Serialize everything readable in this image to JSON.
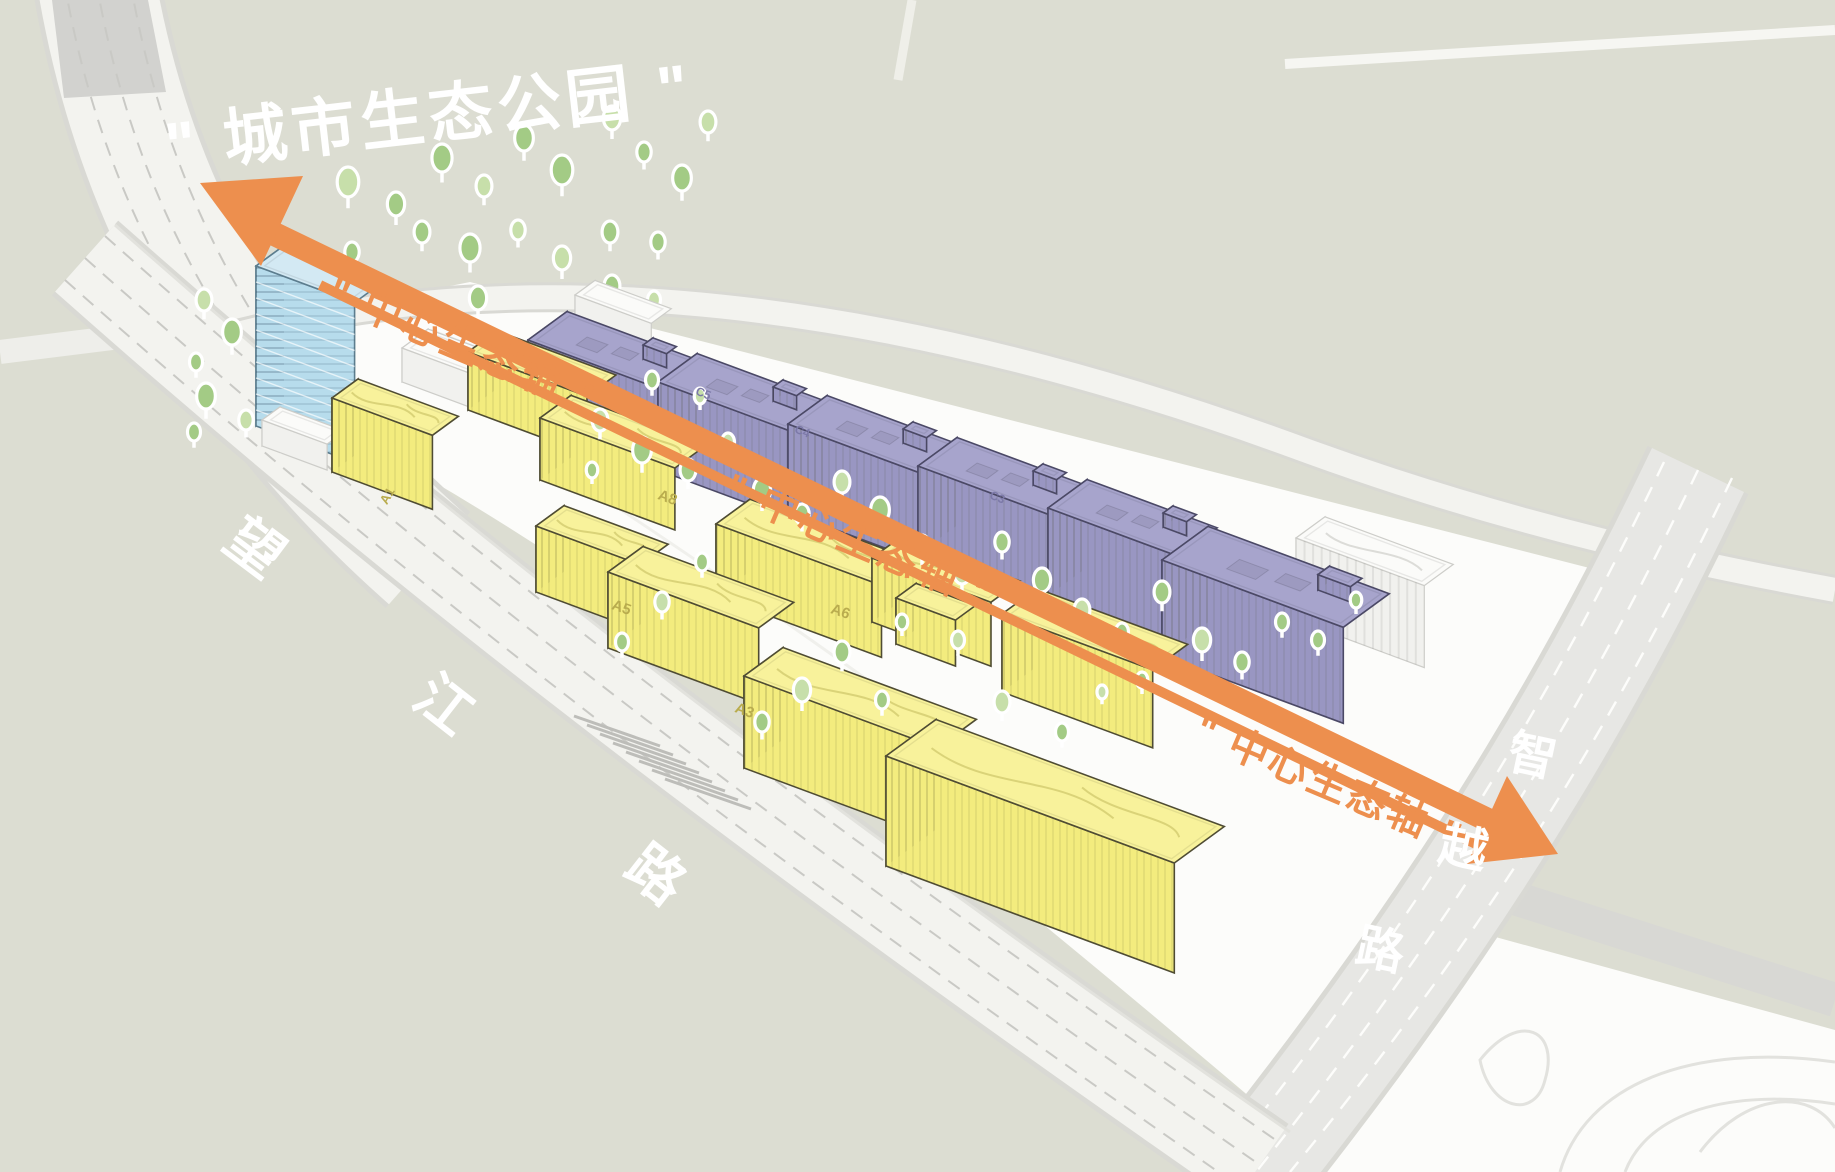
{
  "title": {
    "text": "\" 城市生态公园 \""
  },
  "axis": {
    "label": "\" 中心生态轴 \""
  },
  "roads": {
    "wangjiang": {
      "name": "望江路",
      "chars": [
        "望",
        "江",
        "路"
      ]
    },
    "zhiyue": {
      "name": "智越路",
      "chars": [
        "智",
        "越",
        "路"
      ]
    }
  },
  "buildings": {
    "labels": {
      "a1": "A1",
      "a3": "A3",
      "a5": "A5",
      "a6": "A6",
      "a8": "A8",
      "c3": "C3",
      "c4": "C4",
      "c5": "C5"
    }
  },
  "colors": {
    "background": "#dcddd2",
    "site_white": "#fcfcfa",
    "road_white": "#f3f3ef",
    "road_casing": "#d9d9d4",
    "road_gray": "#e7e7e4",
    "lane_gray": "#c9c9c5",
    "axis_orange": "#ed8f4e",
    "label_white": "#ffffff",
    "tree_green": "#a3cb85",
    "tree_green_light": "#c7dfaa",
    "yellow_roof": "#f8f29b",
    "yellow_face": "#f3ec7e",
    "yellow_side": "#ece470",
    "yellow_edge": "#4f4c33",
    "purple_roof": "#a7a4cc",
    "purple_face": "#9996c2",
    "purple_side": "#8b88b7",
    "purple_edge": "#4b4966",
    "blue_roof": "#d3e9f3",
    "blue_face": "#b7dcec",
    "blue_side": "#a5d0e1",
    "blue_edge": "#5c7d8e",
    "white_roof": "#fbfbf9",
    "white_face": "#f1f1ee",
    "white_side": "#e7e7e3",
    "white_edge": "#cdcdc9",
    "label_dark_yellow": "#b9ac4e",
    "label_dark_purple": "#7c79a8"
  },
  "scene": {
    "trees_back": [
      [
        348,
        182,
        15
      ],
      [
        396,
        204,
        12
      ],
      [
        442,
        158,
        14
      ],
      [
        484,
        186,
        11
      ],
      [
        524,
        138,
        13
      ],
      [
        562,
        170,
        15
      ],
      [
        612,
        118,
        12
      ],
      [
        644,
        152,
        10
      ],
      [
        682,
        178,
        13
      ],
      [
        708,
        122,
        11
      ],
      [
        422,
        232,
        11
      ],
      [
        470,
        248,
        14
      ],
      [
        518,
        230,
        10
      ],
      [
        352,
        252,
        10
      ],
      [
        302,
        282,
        11
      ],
      [
        562,
        258,
        12
      ],
      [
        610,
        232,
        11
      ],
      [
        658,
        242,
        10
      ],
      [
        204,
        300,
        11
      ],
      [
        232,
        332,
        13
      ],
      [
        196,
        362,
        9
      ],
      [
        286,
        346,
        10
      ],
      [
        334,
        302,
        9
      ],
      [
        612,
        286,
        11
      ],
      [
        654,
        300,
        9
      ],
      [
        478,
        298,
        12
      ],
      [
        206,
        396,
        13
      ],
      [
        246,
        420,
        10
      ],
      [
        282,
        440,
        8
      ],
      [
        194,
        432,
        9
      ]
    ],
    "trees_front": [
      [
        600,
        420,
        11
      ],
      [
        642,
        450,
        13
      ],
      [
        688,
        470,
        11
      ],
      [
        728,
        442,
        9
      ],
      [
        762,
        490,
        12
      ],
      [
        802,
        514,
        10
      ],
      [
        842,
        482,
        11
      ],
      [
        880,
        510,
        13
      ],
      [
        922,
        546,
        11
      ],
      [
        962,
        572,
        12
      ],
      [
        1002,
        542,
        10
      ],
      [
        1042,
        580,
        12
      ],
      [
        1082,
        610,
        11
      ],
      [
        1122,
        632,
        9
      ],
      [
        1162,
        592,
        11
      ],
      [
        1202,
        640,
        12
      ],
      [
        1242,
        662,
        10
      ],
      [
        1282,
        622,
        9
      ],
      [
        958,
        640,
        9
      ],
      [
        902,
        622,
        8
      ],
      [
        702,
        562,
        9
      ],
      [
        662,
        602,
        10
      ],
      [
        622,
        642,
        9
      ],
      [
        842,
        652,
        11
      ],
      [
        802,
        690,
        12
      ],
      [
        762,
        722,
        10
      ],
      [
        882,
        700,
        9
      ],
      [
        1002,
        702,
        11
      ],
      [
        1062,
        732,
        9
      ],
      [
        652,
        380,
        9
      ],
      [
        700,
        396,
        8
      ],
      [
        592,
        470,
        8
      ],
      [
        1142,
        680,
        8
      ],
      [
        1102,
        692,
        7
      ],
      [
        1318,
        640,
        9
      ],
      [
        1356,
        600,
        8
      ]
    ],
    "blocks": [
      [
        "white-slab",
        575,
        295,
        82,
        40,
        45,
        "white",
        null
      ],
      [
        "white-podium",
        402,
        348,
        118,
        52,
        34,
        "white",
        null
      ],
      [
        "c5",
        528,
        340,
        140,
        78,
        88,
        "purple",
        "ind"
      ],
      [
        "c4",
        658,
        382,
        140,
        78,
        88,
        "purple",
        "ind"
      ],
      [
        "c3",
        788,
        424,
        140,
        78,
        88,
        "purple",
        "ind"
      ],
      [
        "c2",
        918,
        466,
        140,
        78,
        88,
        "purple",
        "ind"
      ],
      [
        "c1",
        1048,
        508,
        140,
        78,
        88,
        "purple",
        "ind"
      ],
      [
        "parking",
        1296,
        538,
        138,
        58,
        82,
        "white",
        "park"
      ],
      [
        "c0",
        1162,
        560,
        195,
        92,
        96,
        "purple",
        "ind"
      ],
      [
        "tower",
        256,
        266,
        106,
        56,
        160,
        "blue",
        "floors"
      ],
      [
        "tower-pod",
        262,
        420,
        70,
        36,
        26,
        "white",
        null
      ],
      [
        "a1",
        332,
        398,
        108,
        52,
        74,
        "yellow",
        "curve"
      ],
      [
        "a8a",
        468,
        352,
        128,
        58,
        58,
        "yellow",
        "curve"
      ],
      [
        "a8b",
        540,
        418,
        145,
        62,
        62,
        "yellow",
        "curve"
      ],
      [
        "a6",
        716,
        524,
        178,
        68,
        72,
        "yellow",
        "curve"
      ],
      [
        "b1",
        872,
        558,
        128,
        58,
        64,
        "yellow",
        "curve"
      ],
      [
        "a6x",
        896,
        598,
        64,
        40,
        46,
        "yellow",
        null
      ],
      [
        "a5",
        536,
        526,
        112,
        56,
        66,
        "yellow",
        "curve"
      ],
      [
        "a3",
        608,
        572,
        162,
        70,
        76,
        "yellow",
        "curve"
      ],
      [
        "b2",
        1002,
        614,
        162,
        70,
        78,
        "yellow",
        "curve"
      ],
      [
        "w1",
        744,
        676,
        208,
        78,
        92,
        "yellow",
        "curve"
      ],
      [
        "w2",
        886,
        756,
        310,
        100,
        110,
        "yellow",
        "curve"
      ]
    ]
  }
}
